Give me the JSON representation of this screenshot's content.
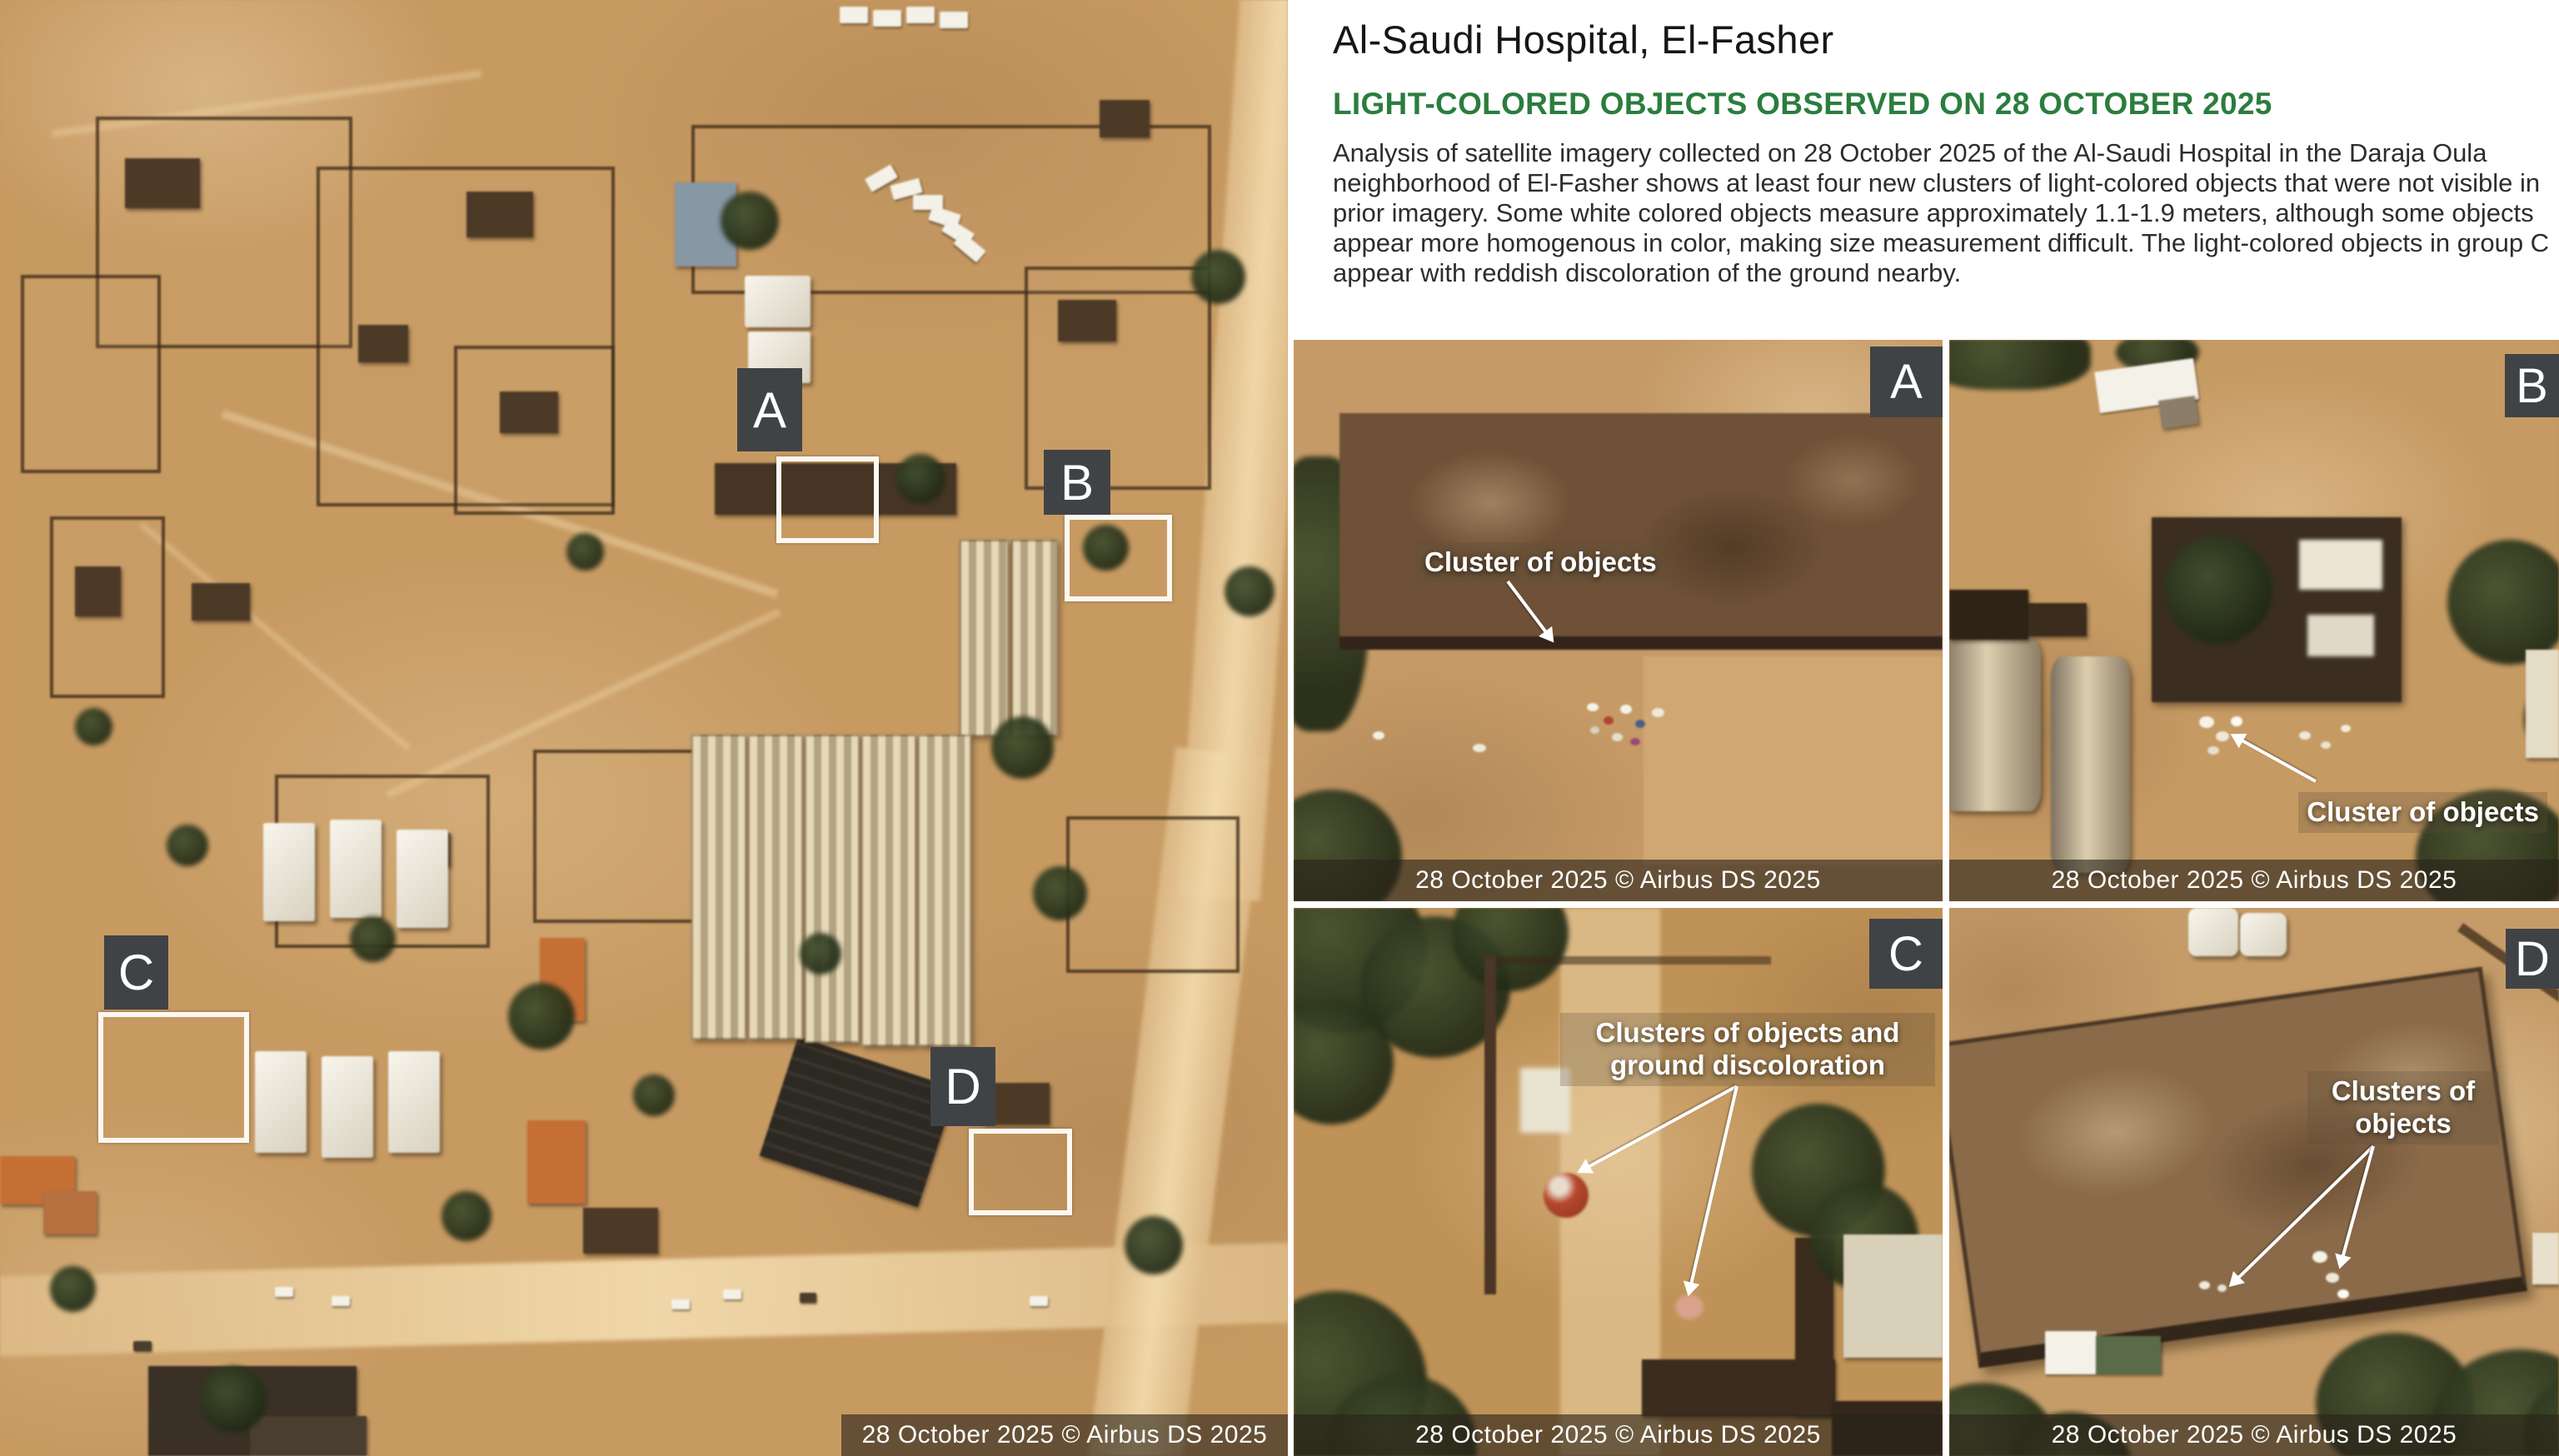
{
  "header": {
    "title": "Al-Saudi Hospital, El-Fasher",
    "subtitle": "LIGHT-COLORED OBJECTS OBSERVED ON 28 OCTOBER 2025",
    "paragraph": "Analysis of satellite imagery collected on 28 October 2025 of the Al-Saudi Hospital in the Daraja Oula neighborhood of El-Fasher shows at least four new clusters of light-colored objects that were not visible in prior imagery. Some white colored objects measure approximately 1.1-1.9 meters, although some objects appear more homogenous in color, making size measurement difficult. The light-colored objects in group C appear with reddish discoloration of the ground nearby."
  },
  "colors": {
    "accent_green": "#2b7d3e",
    "label_box_bg": "#404346",
    "attribution_bar_bg": "rgba(42,35,26,0.62)",
    "outline_box_white": "#faf8f2"
  },
  "main_map": {
    "attribution": "28 October 2025 © Airbus DS 2025",
    "markers": [
      {
        "letter": "A"
      },
      {
        "letter": "B"
      },
      {
        "letter": "C"
      },
      {
        "letter": "D"
      }
    ]
  },
  "panels": [
    {
      "letter": "A",
      "annotation": "Cluster of objects",
      "attribution": "28 October 2025 © Airbus DS 2025"
    },
    {
      "letter": "B",
      "annotation": "Cluster of objects",
      "attribution": "28 October 2025 © Airbus DS 2025"
    },
    {
      "letter": "C",
      "annotation": "Clusters of objects and ground discoloration",
      "attribution": "28 October 2025 © Airbus DS 2025"
    },
    {
      "letter": "D",
      "annotation": "Clusters of objects",
      "attribution": "28 October 2025 © Airbus DS 2025"
    }
  ]
}
